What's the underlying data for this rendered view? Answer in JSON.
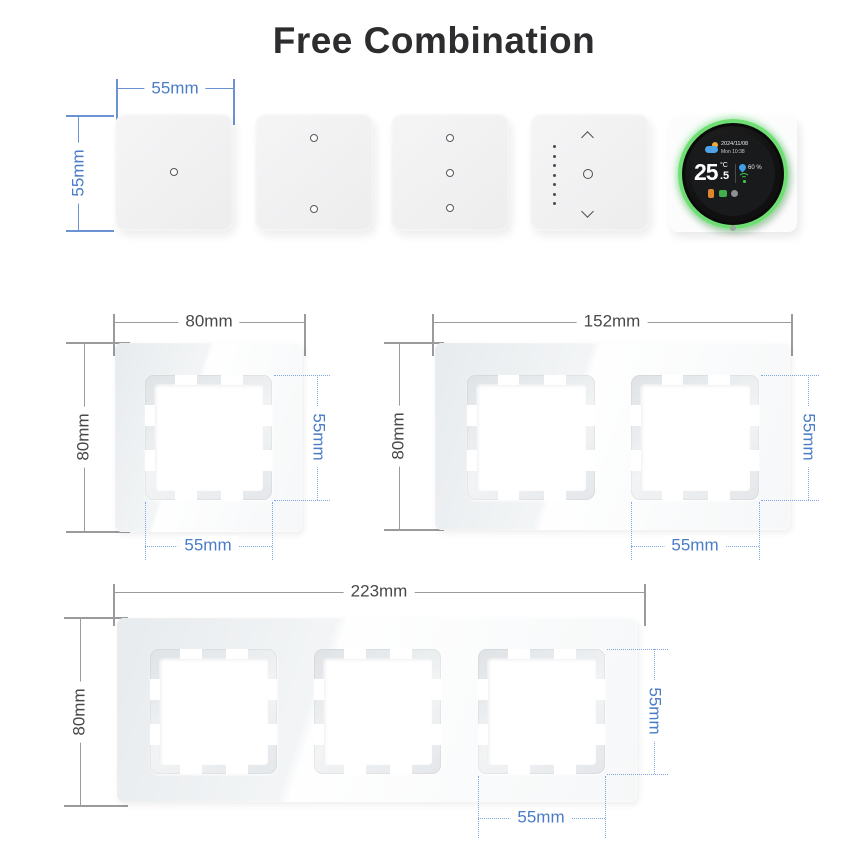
{
  "title": "Free Combination",
  "colors": {
    "dim_blue": "#4a7cc7",
    "dim_gray": "#48484b",
    "ring_green": "#6fdf73"
  },
  "top_row": {
    "width_label": "55mm",
    "height_label": "55mm",
    "modules": [
      {
        "icon": "one-touch-dot"
      },
      {
        "icon": "two-touch-dots"
      },
      {
        "icon": "three-touch-dots"
      },
      {
        "icon": "dimmer-dots-and-arrows"
      },
      {
        "icon": "thermostat-dial"
      }
    ]
  },
  "thermostat": {
    "date": "2024/11/08",
    "time": "Mon 10:38",
    "temperature": "25",
    "unit": "°C",
    "fraction": ".5",
    "humidity": "60 %"
  },
  "frames": {
    "single": {
      "width": "80mm",
      "height": "80mm",
      "opening_width": "55mm",
      "opening_height": "55mm"
    },
    "double": {
      "width": "152mm",
      "height": "80mm",
      "opening_width": "55mm",
      "opening_height": "55mm"
    },
    "triple": {
      "width": "223mm",
      "height": "80mm",
      "opening_width": "55mm",
      "opening_height": "55mm"
    }
  }
}
